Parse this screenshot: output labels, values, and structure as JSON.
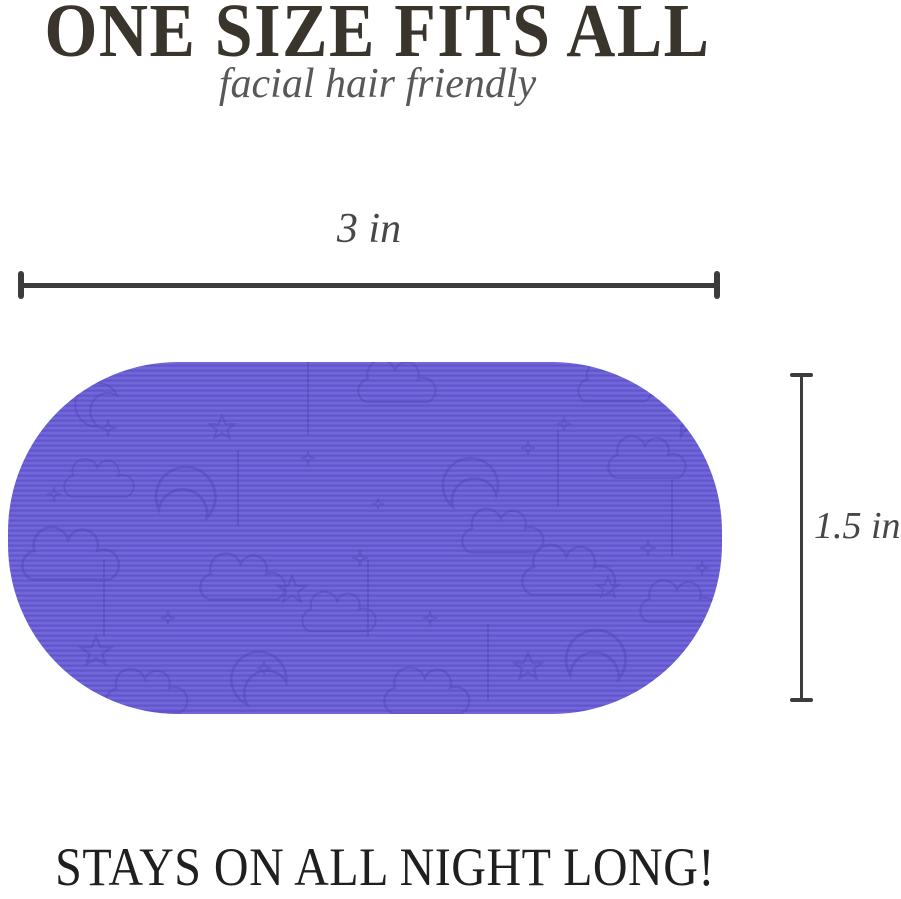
{
  "header": {
    "title": "ONE SIZE FITS ALL",
    "subtitle": "facial hair friendly"
  },
  "size_diagram": {
    "width_label": "3 in",
    "height_label": "1.5 in"
  },
  "footer": {
    "tagline": "STAYS ON ALL NIGHT LONG!"
  },
  "colors": {
    "title_text": "#3A352C",
    "subtitle_text": "#585858",
    "dimension_text": "#474747",
    "dimension_line": "#3C3C3C",
    "patch_purple": "#6A5ED6",
    "patch_pattern": "#4A3EB0",
    "footer_text": "#1F1F1F",
    "background": "#FFFFFF"
  }
}
